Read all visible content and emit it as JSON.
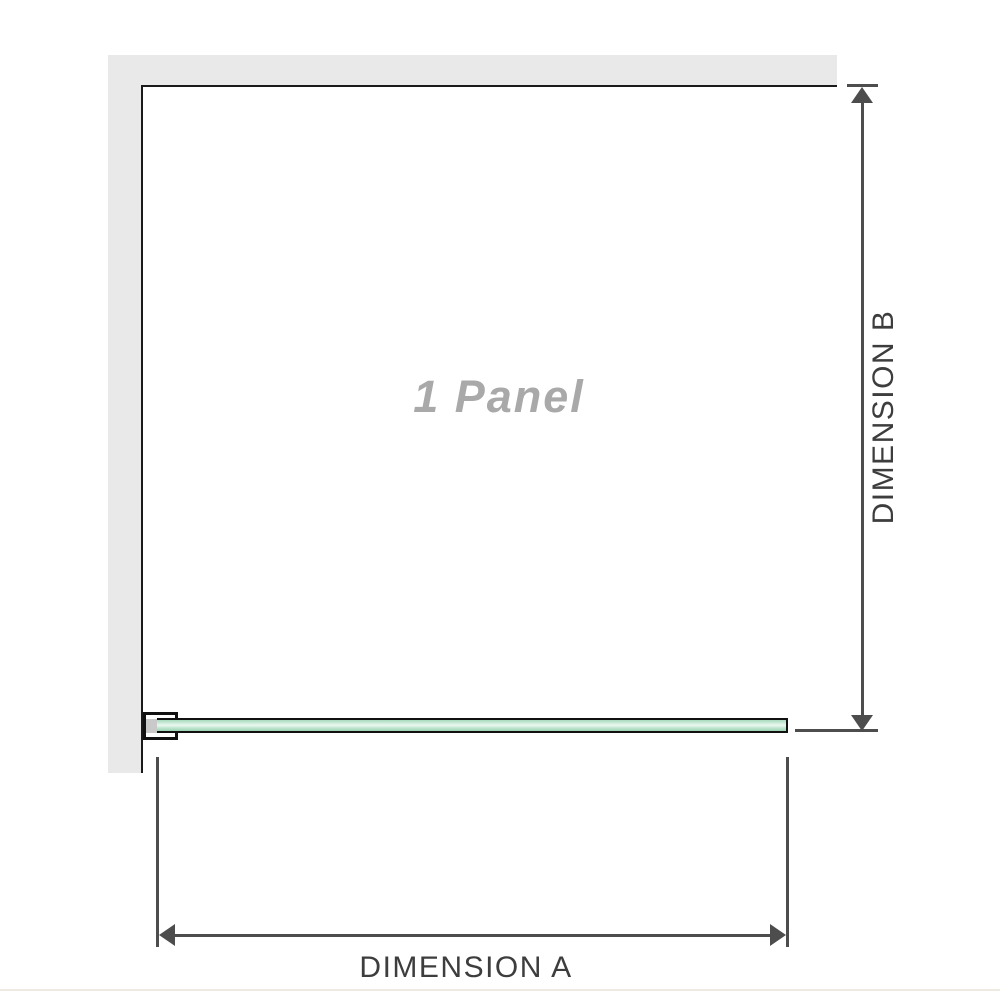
{
  "diagram": {
    "title": "Shower screen panel dimension diagram",
    "panel_label": "1 Panel",
    "dimension_a": {
      "label": "DIMENSION A",
      "orientation": "horizontal"
    },
    "dimension_b": {
      "label": "DIMENSION B",
      "orientation": "vertical"
    },
    "colors": {
      "background": "#ffffff",
      "wall_fill": "#e9e9e9",
      "wall_edge_outline": "#1a1a1a",
      "dimension_lines": "#4d4d4d",
      "dimension_label_text": "#3d3d3d",
      "panel_label_text": "#a9a9a9",
      "glass_green_mid": "#a7dabd",
      "glass_green_light": "#ebf8f0",
      "glass_green_dark": "#9cd2b2",
      "bracket_outline": "#111111",
      "bracket_inner_fill": "#c9c9c9"
    }
  }
}
